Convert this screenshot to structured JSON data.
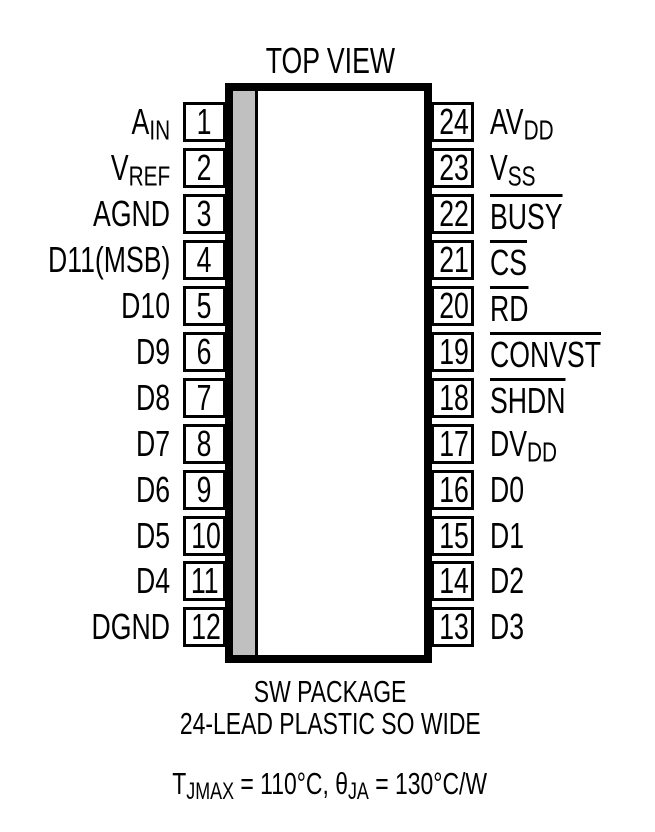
{
  "title": "TOP VIEW",
  "package": {
    "name": "SW PACKAGE",
    "description": "24-LEAD PLASTIC SO WIDE"
  },
  "thermal_note": {
    "t1": "T",
    "s1": "JMAX",
    "t2": " = 110°C, θ",
    "s2": "JA",
    "t3": " = 130°C/W"
  },
  "colors": {
    "ink": "#000000",
    "body_stripe": "#c0c0c0",
    "background": "#ffffff"
  },
  "pins": {
    "left": [
      {
        "number": "1",
        "base": "A",
        "sub": "IN",
        "overline": false
      },
      {
        "number": "2",
        "base": "V",
        "sub": "REF",
        "overline": false
      },
      {
        "number": "3",
        "base": "AGND",
        "sub": "",
        "overline": false
      },
      {
        "number": "4",
        "base": "D11(MSB)",
        "sub": "",
        "overline": false
      },
      {
        "number": "5",
        "base": "D10",
        "sub": "",
        "overline": false
      },
      {
        "number": "6",
        "base": "D9",
        "sub": "",
        "overline": false
      },
      {
        "number": "7",
        "base": "D8",
        "sub": "",
        "overline": false
      },
      {
        "number": "8",
        "base": "D7",
        "sub": "",
        "overline": false
      },
      {
        "number": "9",
        "base": "D6",
        "sub": "",
        "overline": false
      },
      {
        "number": "10",
        "base": "D5",
        "sub": "",
        "overline": false
      },
      {
        "number": "11",
        "base": "D4",
        "sub": "",
        "overline": false
      },
      {
        "number": "12",
        "base": "DGND",
        "sub": "",
        "overline": false
      }
    ],
    "right": [
      {
        "number": "24",
        "base": "AV",
        "sub": "DD",
        "overline": false
      },
      {
        "number": "23",
        "base": "V",
        "sub": "SS",
        "overline": false
      },
      {
        "number": "22",
        "base": "BUSY",
        "sub": "",
        "overline": true
      },
      {
        "number": "21",
        "base": "CS",
        "sub": "",
        "overline": true
      },
      {
        "number": "20",
        "base": "RD",
        "sub": "",
        "overline": true
      },
      {
        "number": "19",
        "base": "CONVST",
        "sub": "",
        "overline": true
      },
      {
        "number": "18",
        "base": "SHDN",
        "sub": "",
        "overline": true
      },
      {
        "number": "17",
        "base": "DV",
        "sub": "DD",
        "overline": false
      },
      {
        "number": "16",
        "base": "D0",
        "sub": "",
        "overline": false
      },
      {
        "number": "15",
        "base": "D1",
        "sub": "",
        "overline": false
      },
      {
        "number": "14",
        "base": "D2",
        "sub": "",
        "overline": false
      },
      {
        "number": "13",
        "base": "D3",
        "sub": "",
        "overline": false
      }
    ]
  }
}
